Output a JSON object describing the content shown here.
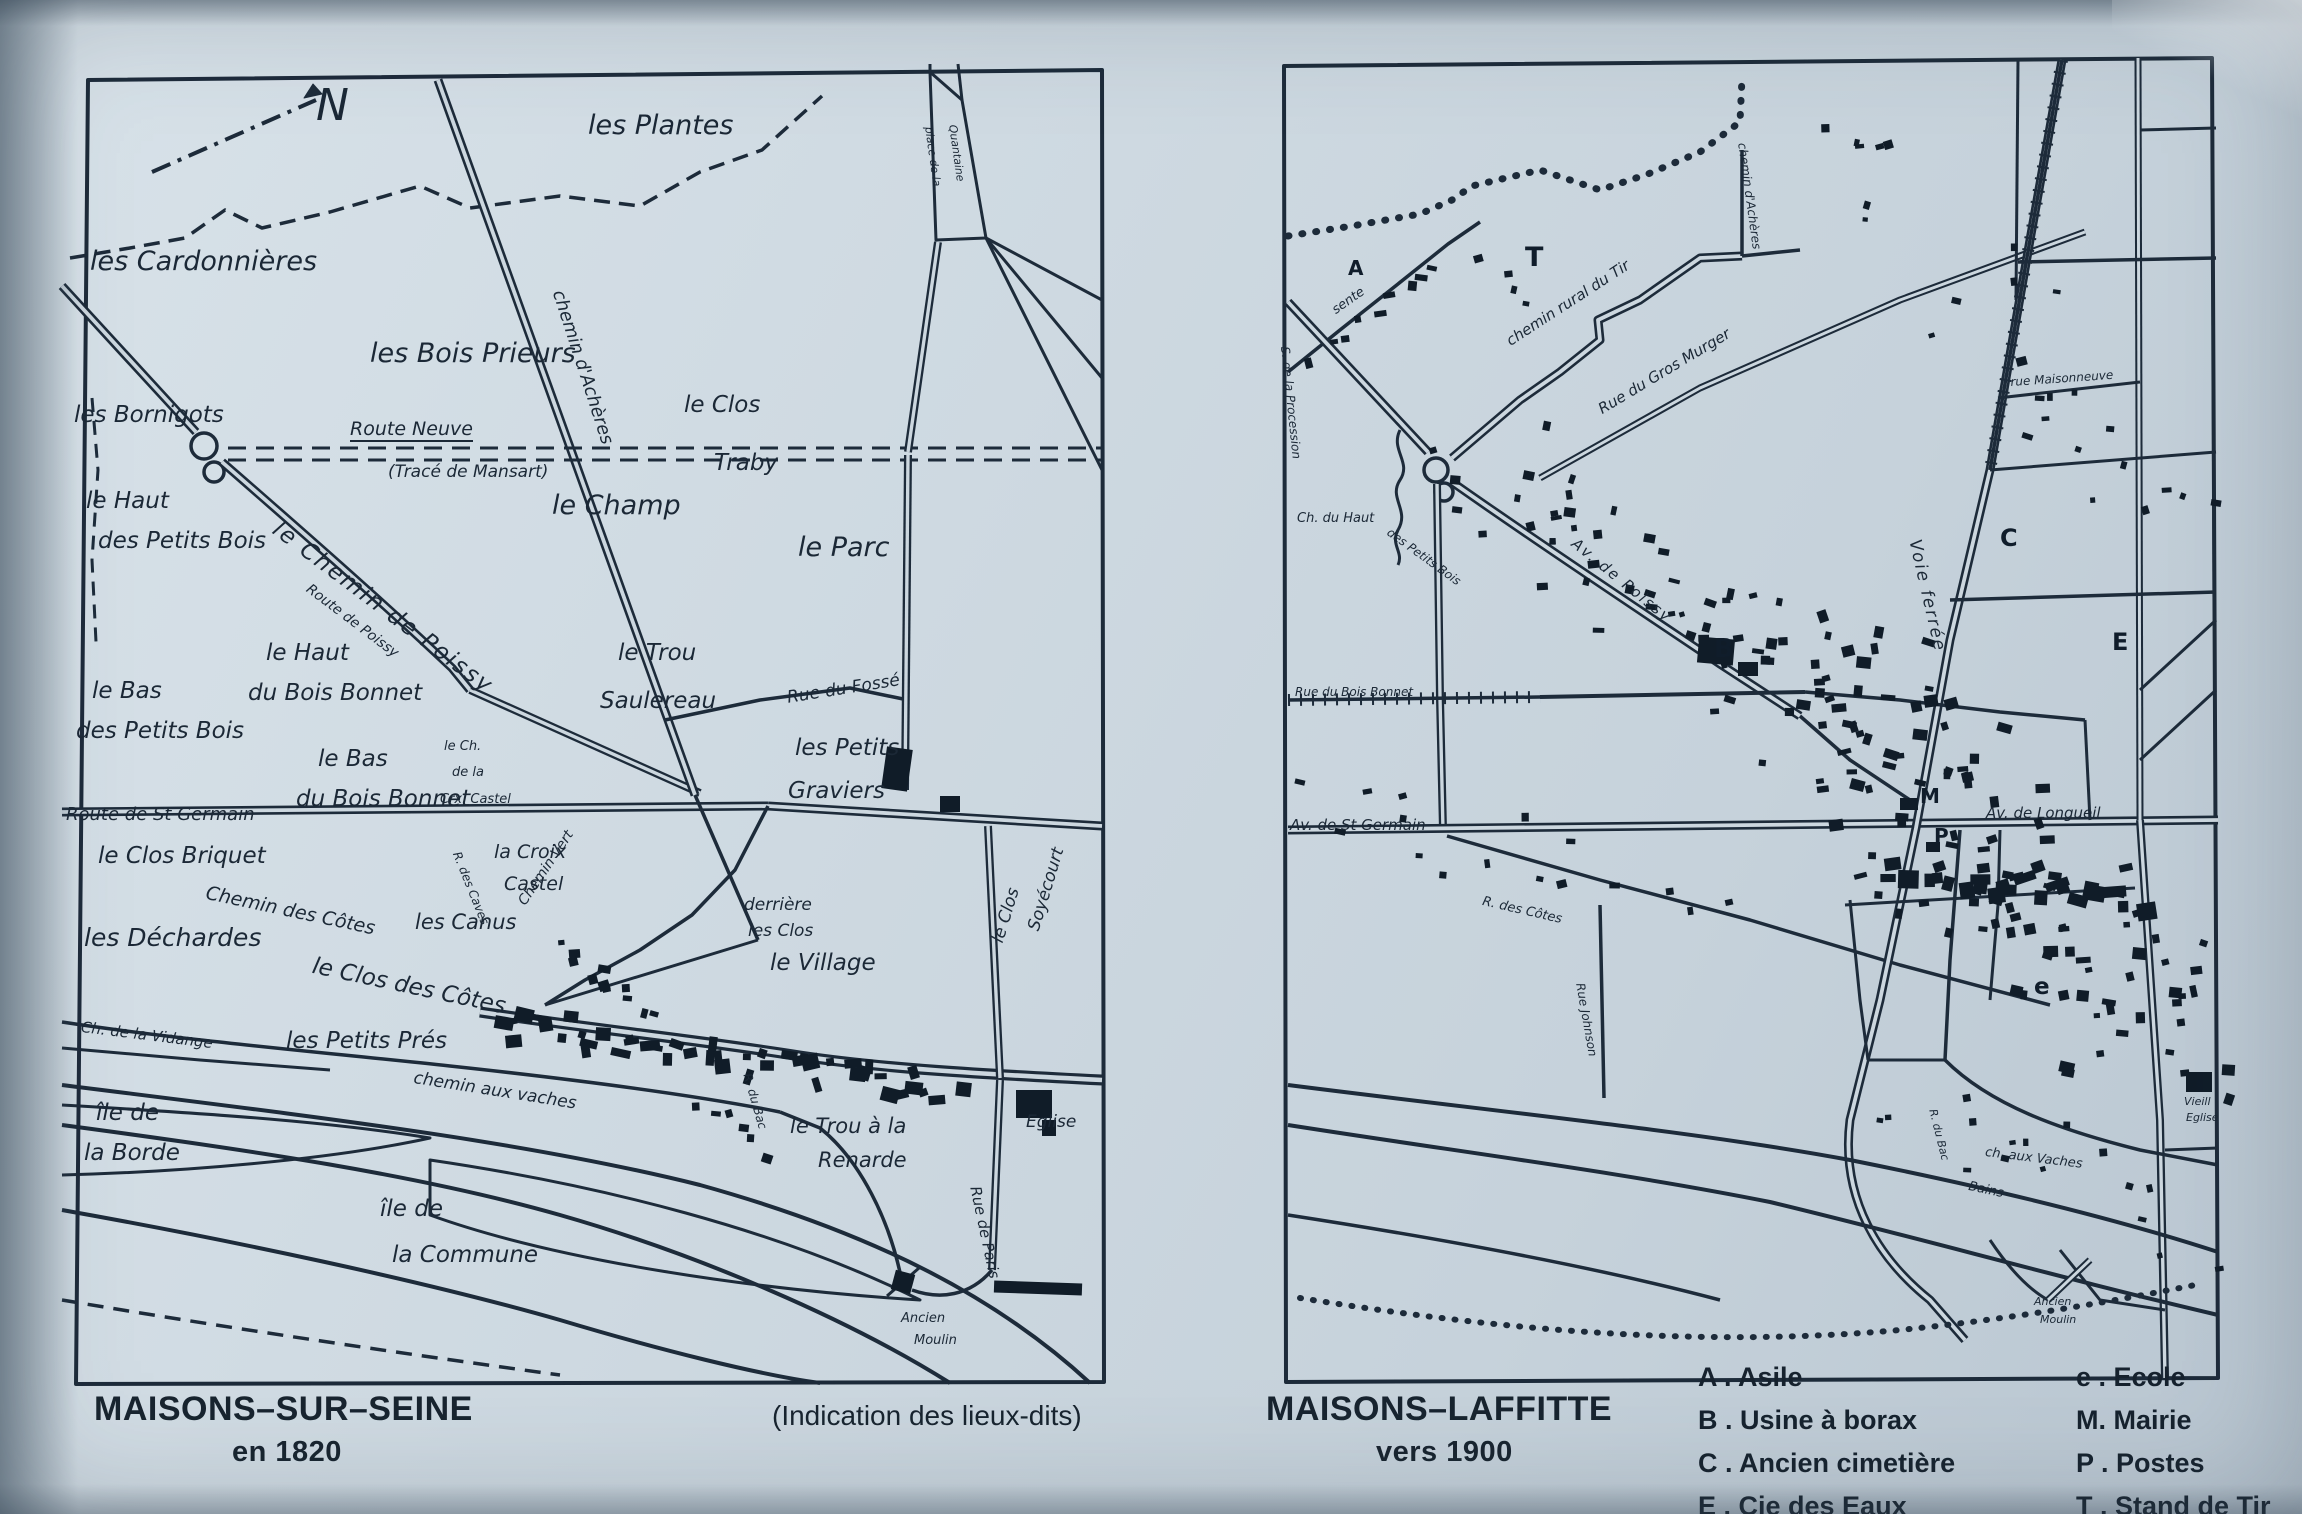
{
  "page": {
    "paper_color": "#ccd7df",
    "ink_color": "#1d2b3a"
  },
  "left_map": {
    "caption_title": "MAISONS–SUR–SEINE",
    "caption_subtitle": "en 1820",
    "note": "(Indication des lieux-dits)",
    "labels": [
      {
        "t": "N",
        "x": 316,
        "y": 84,
        "s": 44,
        "n": "north-indicator"
      },
      {
        "t": "les Plantes",
        "x": 588,
        "y": 112,
        "s": 27
      },
      {
        "t": "les Cardonnières",
        "x": 90,
        "y": 248,
        "s": 27
      },
      {
        "t": "les Bois Prieurs",
        "x": 370,
        "y": 340,
        "s": 27
      },
      {
        "t": "les Bornigots",
        "x": 74,
        "y": 404,
        "s": 23
      },
      {
        "t": "Route Neuve",
        "x": 350,
        "y": 420,
        "s": 19,
        "u": 1,
        "n": "street-label"
      },
      {
        "t": "(Tracé de Mansart)",
        "x": 388,
        "y": 464,
        "s": 17
      },
      {
        "t": "le Clos",
        "x": 684,
        "y": 394,
        "s": 23
      },
      {
        "t": "Traby",
        "x": 714,
        "y": 452,
        "s": 23
      },
      {
        "t": "le Champ",
        "x": 552,
        "y": 492,
        "s": 27
      },
      {
        "t": "le Parc",
        "x": 798,
        "y": 534,
        "s": 27
      },
      {
        "t": "chemin d'Achères",
        "x": 566,
        "y": 288,
        "s": 18,
        "r": 72,
        "n": "street-label"
      },
      {
        "t": "place de la",
        "x": 934,
        "y": 126,
        "s": 11,
        "r": 82,
        "n": "street-label"
      },
      {
        "t": "Quantaine",
        "x": 958,
        "y": 124,
        "s": 11,
        "r": 82,
        "n": "street-label"
      },
      {
        "t": "le Haut",
        "x": 86,
        "y": 490,
        "s": 23
      },
      {
        "t": "des Petits Bois",
        "x": 98,
        "y": 530,
        "s": 23
      },
      {
        "t": "le Chemin de Poissy",
        "x": 282,
        "y": 518,
        "s": 23,
        "r": 37,
        "ls": 2,
        "n": "street-label"
      },
      {
        "t": "Route de Poissy",
        "x": 312,
        "y": 582,
        "s": 14,
        "r": 37,
        "n": "street-label"
      },
      {
        "t": "le Haut",
        "x": 266,
        "y": 642,
        "s": 23
      },
      {
        "t": "du Bois Bonnet",
        "x": 248,
        "y": 682,
        "s": 23
      },
      {
        "t": "le Bas",
        "x": 92,
        "y": 680,
        "s": 23
      },
      {
        "t": "des Petits Bois",
        "x": 76,
        "y": 720,
        "s": 23
      },
      {
        "t": "le Trou",
        "x": 618,
        "y": 642,
        "s": 23
      },
      {
        "t": "Saulereau",
        "x": 600,
        "y": 690,
        "s": 23
      },
      {
        "t": "le Bas",
        "x": 318,
        "y": 748,
        "s": 23
      },
      {
        "t": "du Bois Bonnet",
        "x": 296,
        "y": 788,
        "s": 23
      },
      {
        "t": "le Ch.",
        "x": 444,
        "y": 740,
        "s": 13
      },
      {
        "t": "de la",
        "x": 452,
        "y": 766,
        "s": 13
      },
      {
        "t": "Crx. Castel",
        "x": 440,
        "y": 793,
        "s": 13
      },
      {
        "t": "Rue du Fossé",
        "x": 786,
        "y": 690,
        "s": 17,
        "r": -9,
        "n": "street-label"
      },
      {
        "t": "les Petits",
        "x": 795,
        "y": 737,
        "s": 23
      },
      {
        "t": "Graviers",
        "x": 788,
        "y": 780,
        "s": 23
      },
      {
        "t": "Route de St Germain",
        "x": 66,
        "y": 806,
        "s": 18,
        "n": "street-label"
      },
      {
        "t": "le Clos Briquet",
        "x": 98,
        "y": 845,
        "s": 23
      },
      {
        "t": "Chemin des Côtes",
        "x": 208,
        "y": 884,
        "s": 19,
        "r": 12,
        "n": "street-label"
      },
      {
        "t": "les Canus",
        "x": 415,
        "y": 912,
        "s": 21
      },
      {
        "t": "la Croix",
        "x": 494,
        "y": 843,
        "s": 19
      },
      {
        "t": "Castel",
        "x": 504,
        "y": 875,
        "s": 19
      },
      {
        "t": "R. des Caves",
        "x": 462,
        "y": 850,
        "s": 12,
        "r": 68,
        "n": "street-label"
      },
      {
        "t": "Chemin Vert",
        "x": 516,
        "y": 900,
        "s": 14,
        "r": -56,
        "n": "street-label"
      },
      {
        "t": "les Déchardes",
        "x": 84,
        "y": 925,
        "s": 25
      },
      {
        "t": "le Clos des Côtes",
        "x": 315,
        "y": 955,
        "s": 23,
        "r": 12
      },
      {
        "t": "Ch. de la Vidange",
        "x": 82,
        "y": 1020,
        "s": 15,
        "r": 7,
        "n": "street-label"
      },
      {
        "t": "les Petits Prés",
        "x": 286,
        "y": 1030,
        "s": 23
      },
      {
        "t": "chemin aux vaches",
        "x": 415,
        "y": 1070,
        "s": 17,
        "r": 9,
        "n": "street-label"
      },
      {
        "t": "derrière",
        "x": 744,
        "y": 897,
        "s": 17
      },
      {
        "t": "les Clos",
        "x": 748,
        "y": 923,
        "s": 17
      },
      {
        "t": "le Village",
        "x": 770,
        "y": 952,
        "s": 23
      },
      {
        "t": "le Clos",
        "x": 990,
        "y": 940,
        "s": 17,
        "r": -73
      },
      {
        "t": "Soyécourt",
        "x": 1026,
        "y": 928,
        "s": 17,
        "r": -73
      },
      {
        "t": "le Trou à la",
        "x": 790,
        "y": 1116,
        "s": 21
      },
      {
        "t": "Renarde",
        "x": 818,
        "y": 1150,
        "s": 21
      },
      {
        "t": "Eglise",
        "x": 1026,
        "y": 1114,
        "s": 17
      },
      {
        "t": "Rue de Paris",
        "x": 982,
        "y": 1185,
        "s": 15,
        "r": 78,
        "n": "street-label"
      },
      {
        "t": "R. du Bac",
        "x": 753,
        "y": 1072,
        "s": 12,
        "r": 74,
        "n": "street-label"
      },
      {
        "t": "Ancien",
        "x": 901,
        "y": 1312,
        "s": 13
      },
      {
        "t": "Moulin",
        "x": 914,
        "y": 1334,
        "s": 13
      },
      {
        "t": "île de",
        "x": 96,
        "y": 1102,
        "s": 23
      },
      {
        "t": "la Borde",
        "x": 84,
        "y": 1142,
        "s": 23
      },
      {
        "t": "île de",
        "x": 380,
        "y": 1198,
        "s": 23
      },
      {
        "t": "la Commune",
        "x": 392,
        "y": 1244,
        "s": 23
      }
    ]
  },
  "right_map": {
    "caption_title": "MAISONS–LAFFITTE",
    "caption_subtitle": "vers 1900",
    "labels": [
      {
        "t": "sente",
        "x": 1330,
        "y": 306,
        "s": 13,
        "r": -35,
        "n": "street-label"
      },
      {
        "t": "S. de la Procession",
        "x": 1291,
        "y": 346,
        "s": 12,
        "r": 84,
        "n": "street-label"
      },
      {
        "t": "chemin rural du Tir",
        "x": 1504,
        "y": 336,
        "s": 15,
        "r": -33,
        "n": "street-label"
      },
      {
        "t": "Rue du Gros Murger",
        "x": 1596,
        "y": 404,
        "s": 15,
        "r": -31,
        "n": "street-label"
      },
      {
        "t": "chemin d'Achères",
        "x": 1748,
        "y": 142,
        "s": 12,
        "r": 82,
        "n": "street-label"
      },
      {
        "t": "Ch. du Haut",
        "x": 1297,
        "y": 512,
        "s": 13,
        "n": "street-label"
      },
      {
        "t": "des Petits Bois",
        "x": 1392,
        "y": 526,
        "s": 12,
        "r": 36,
        "n": "street-label"
      },
      {
        "t": "Av. de Poissy",
        "x": 1578,
        "y": 536,
        "s": 15,
        "r": 39,
        "ls": 2,
        "n": "street-label"
      },
      {
        "t": "Rue du Bois Bonnet",
        "x": 1295,
        "y": 686,
        "s": 12,
        "n": "street-label"
      },
      {
        "t": "Av. de St Germain",
        "x": 1290,
        "y": 818,
        "s": 15,
        "n": "street-label"
      },
      {
        "t": "R. des Côtes",
        "x": 1484,
        "y": 895,
        "s": 13,
        "r": 13,
        "n": "street-label"
      },
      {
        "t": "Rue Johnson",
        "x": 1586,
        "y": 982,
        "s": 12,
        "r": 80,
        "n": "street-label"
      },
      {
        "t": "rue Maisonneuve",
        "x": 2010,
        "y": 376,
        "s": 12,
        "r": -4,
        "n": "street-label"
      },
      {
        "t": "Voie ferrée",
        "x": 1922,
        "y": 538,
        "s": 17,
        "r": 77,
        "ls": 2,
        "n": "street-label"
      },
      {
        "t": "Av. de Longueil",
        "x": 1986,
        "y": 806,
        "s": 15,
        "n": "street-label"
      },
      {
        "t": "ch. aux Vaches",
        "x": 1986,
        "y": 1146,
        "s": 13,
        "r": 7,
        "n": "street-label"
      },
      {
        "t": "Bains",
        "x": 1970,
        "y": 1180,
        "s": 13,
        "r": 12
      },
      {
        "t": "Vieill",
        "x": 2184,
        "y": 1096,
        "s": 11
      },
      {
        "t": "Eglise",
        "x": 2186,
        "y": 1112,
        "s": 11
      },
      {
        "t": "R. du Bac",
        "x": 1938,
        "y": 1108,
        "s": 11,
        "r": 76,
        "n": "street-label"
      },
      {
        "t": "Ancien",
        "x": 2034,
        "y": 1296,
        "s": 11
      },
      {
        "t": "Moulin",
        "x": 2040,
        "y": 1314,
        "s": 11
      }
    ],
    "markers": [
      {
        "t": "T",
        "x": 1525,
        "y": 244,
        "s": 27
      },
      {
        "t": "A",
        "x": 1348,
        "y": 258,
        "s": 20
      },
      {
        "t": "B",
        "x": 1714,
        "y": 636,
        "s": 26
      },
      {
        "t": "C",
        "x": 2000,
        "y": 526,
        "s": 24
      },
      {
        "t": "E",
        "x": 2112,
        "y": 630,
        "s": 24
      },
      {
        "t": "M",
        "x": 1920,
        "y": 786,
        "s": 20
      },
      {
        "t": "P",
        "x": 1934,
        "y": 826,
        "s": 20
      },
      {
        "t": "e",
        "x": 2034,
        "y": 976,
        "s": 23
      }
    ],
    "legend": {
      "col1": [
        "A . Asile",
        "B . Usine à borax",
        "C . Ancien cimetière",
        "E . Cie des Eaux"
      ],
      "col2": [
        "e . Ecole",
        "M. Mairie",
        "P . Postes",
        "T . Stand de Tir"
      ]
    }
  }
}
